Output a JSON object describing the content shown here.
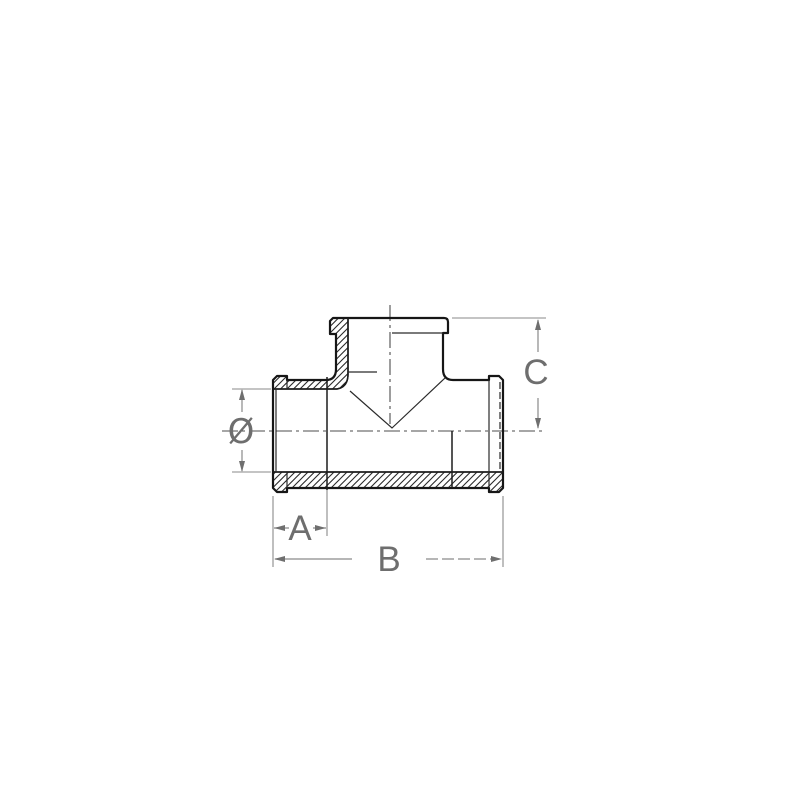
{
  "drawing": {
    "subject": "threaded-tee-pipe-fitting-section",
    "labels": {
      "diameter": "Ø",
      "a": "A",
      "b": "B",
      "c": "C"
    },
    "colors": {
      "background": "#ffffff",
      "outline": "#161616",
      "hatch": "#2a2a2a",
      "dimension_lines": "#8a8a8a",
      "labels": "#6e6e6e"
    }
  }
}
